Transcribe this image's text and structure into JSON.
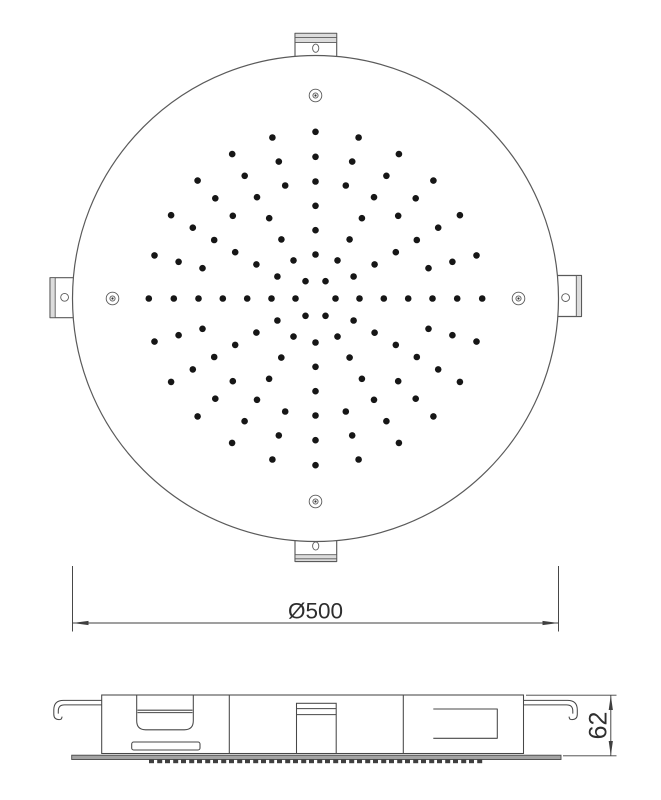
{
  "drawing": {
    "type": "shower-head-technical-drawing",
    "labels": {
      "diameter": "Ø500",
      "height": "62"
    },
    "plan_view": {
      "center": {
        "x": 315.5,
        "y": 298.5
      },
      "radius": 243,
      "screw_hole_offset": 203,
      "nozzle_pattern": {
        "dot_radius": 3.3,
        "ring_radii": [
          20,
          44,
          68.3,
          92.7,
          117,
          141.7,
          166.7
        ],
        "spokes": [
          {
            "angles": [
              0,
              60,
              120,
              180,
              240,
              300
            ],
            "rings": [
              0,
              1,
              2,
              3,
              4,
              5,
              6
            ]
          },
          {
            "angles": [
              30,
              90,
              150,
              210,
              270,
              330
            ],
            "rings": [
              1,
              2,
              3,
              4,
              5,
              6
            ]
          },
          {
            "angles": [
              15,
              45,
              75,
              105,
              135,
              165,
              195,
              225,
              255,
              285,
              315,
              345
            ],
            "rings": [
              4,
              5,
              6
            ]
          }
        ]
      }
    },
    "side_view": {
      "teeth": {
        "y": 759.4,
        "x_start": 149,
        "x_end": 483,
        "pair_step": 16,
        "tooth_width": 5,
        "inner_gap": 3.2,
        "height": 3.8
      }
    },
    "colors": {
      "line": "#5a5a5a",
      "side_line": "#474747",
      "dim_line": "#3f3f3f",
      "text": "#2e2e2e",
      "dot": "#161616",
      "plate_fill": "#a3a3a3",
      "teeth_fill": "#3f3f3f",
      "band_fill": "#dcdcdc"
    }
  }
}
